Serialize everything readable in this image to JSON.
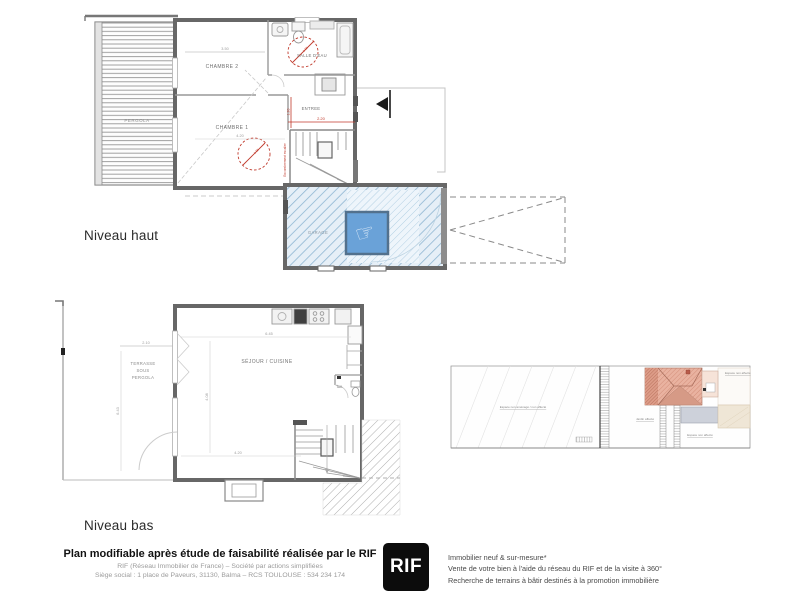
{
  "colors": {
    "wall": "#676767",
    "annotation_red": "#c0392b",
    "garage_hatch": "#8fb6d2",
    "hotspot_blue": "#6aa2d8",
    "roof_orange": "#e9b2a0",
    "logo_bg": "#0c0c0c",
    "logo_text": "#ffffff"
  },
  "upper_plan": {
    "level_label": "Niveau haut",
    "room_chambre2": "CHAMBRE 2",
    "room_chambre1": "CHAMBRE 1",
    "room_salle_deau": "SALLE D'EAU",
    "room_entree": "ENTREE",
    "room_garage": "GARAGE",
    "pergola_label": "PERGOLA",
    "dim_chambre2": "3.50",
    "dim_chambre1": "4.20",
    "dim_entree_w": "2.20",
    "dim_entree_h": "1.20",
    "dim_circle_1": "1.50",
    "dim_circle_2": "1.50",
    "stair_note": "Encombrement escalier",
    "hotspot_icon": "☞"
  },
  "lower_plan": {
    "level_label": "Niveau bas",
    "terrasse_lines": [
      "TERRASSE",
      "SOUS",
      "PERGOLA"
    ],
    "room_sejour": "SÉJOUR / CUISINE",
    "room_toilettes": "Toil.",
    "dim_top": "6.45",
    "dim_bottom": "4.20",
    "dim_terrace_w": "2.10",
    "dim_terrace_h": "6.43",
    "dim_room_h": "4.08"
  },
  "site_plan": {
    "label_garden": "Espace non aménagé / non affecté",
    "label_jardin": "Jardin affecté",
    "label_espace_1": "Espace non affecté",
    "label_espace_2": "Espace non affecté"
  },
  "footer": {
    "disclaimer": "Plan modifiable après étude de faisabilité réalisée par le RIF",
    "company_line1": "RIF (Réseau Immobilier de France) – Société par actions simplifiées",
    "company_line2": "Siège social : 1 place de Paveurs, 31130, Balma – RCS TOULOUSE : 534 234 174",
    "logo_text": "RIF",
    "services": [
      "Immobilier neuf & sur-mesure*",
      "Vente de votre bien à l'aide du réseau du RIF et de la visite à 360°",
      "Recherche de terrains à bâtir destinés à la promotion immobilière"
    ]
  }
}
